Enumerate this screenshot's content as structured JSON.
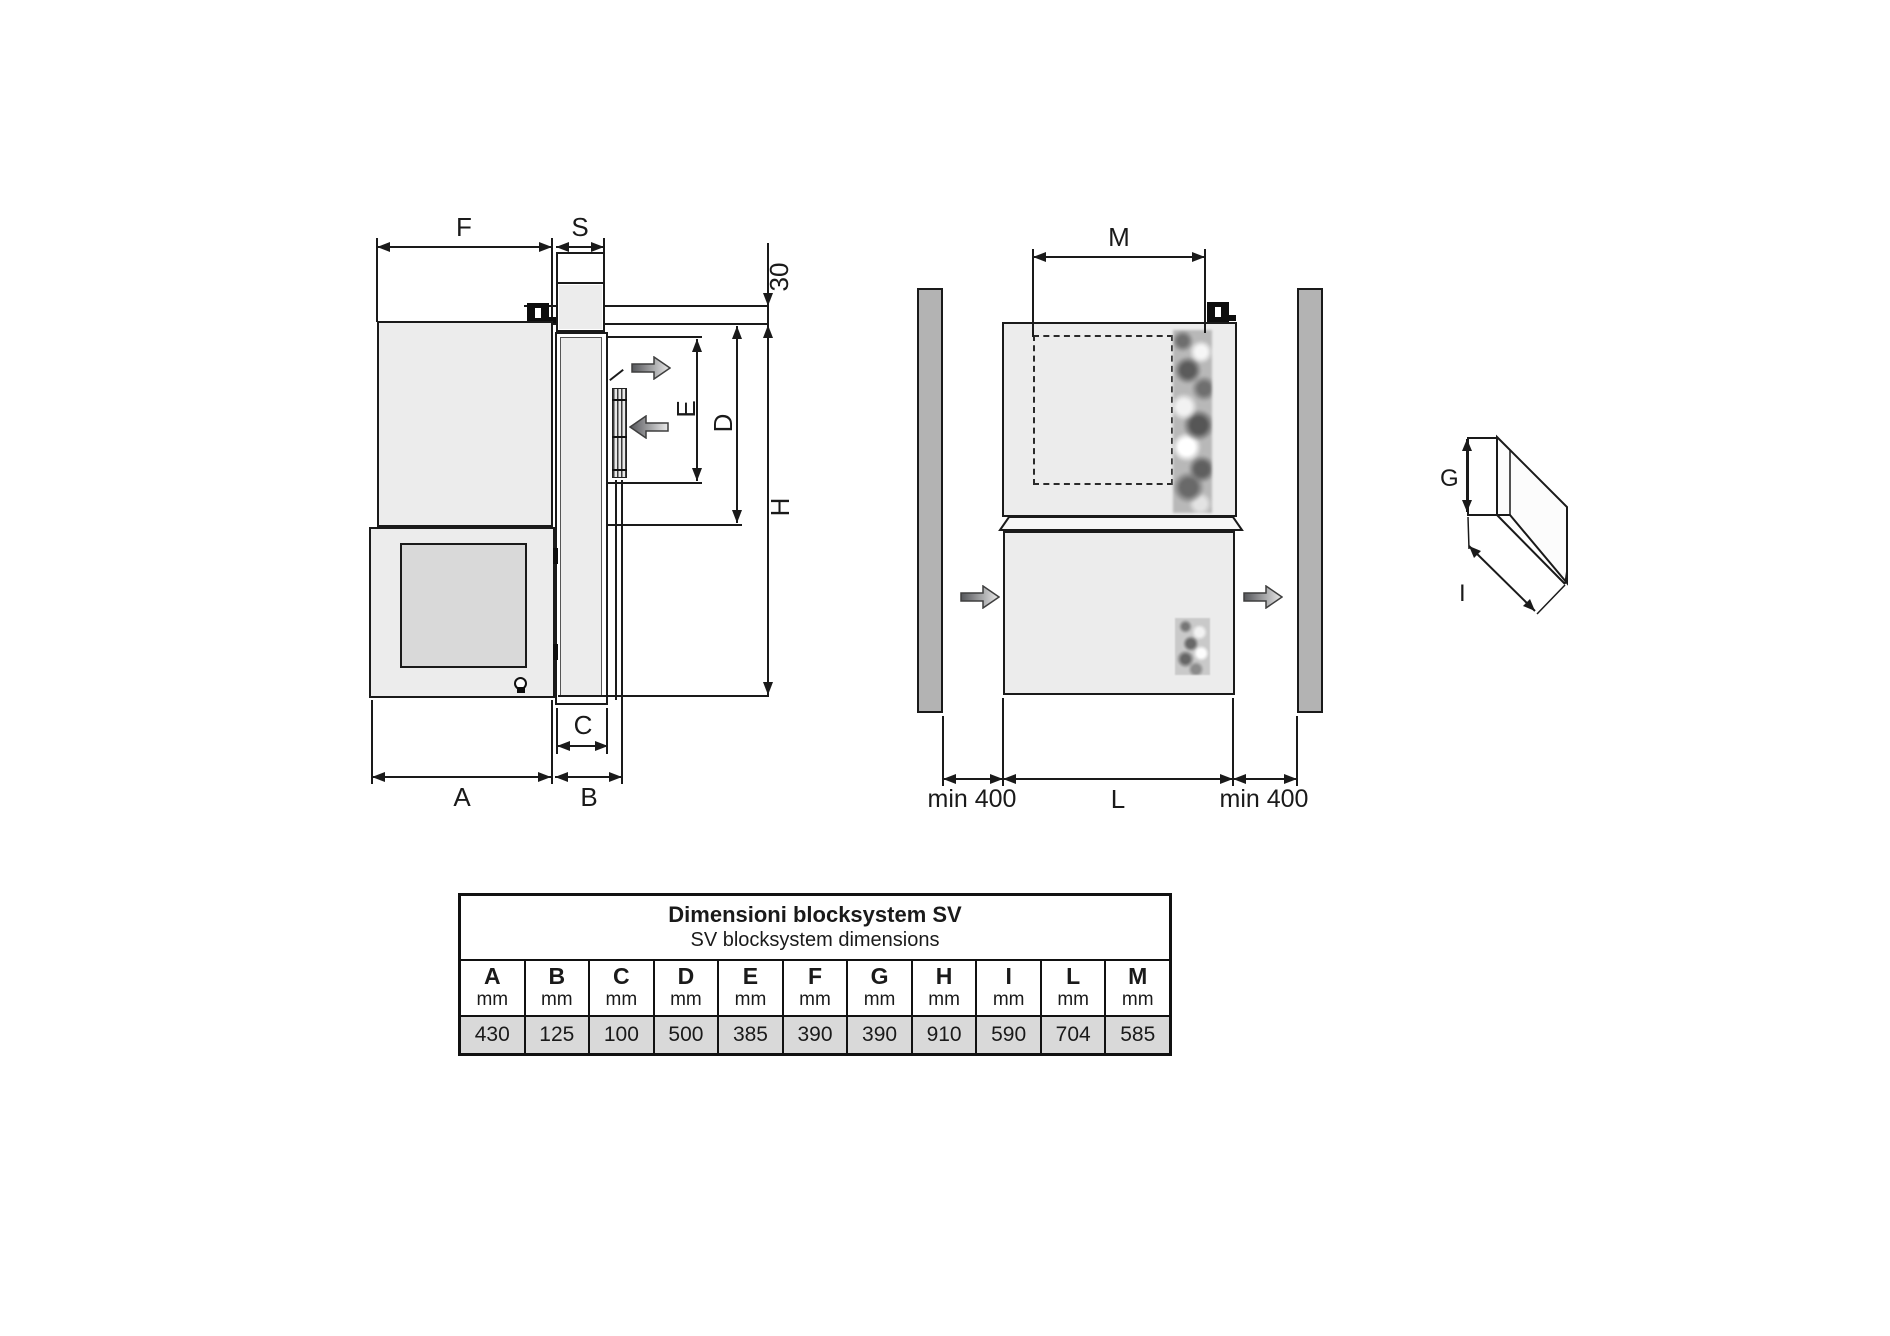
{
  "colors": {
    "line": "#1a1a1a",
    "body_fill": "#ececec",
    "door_fill": "#d9d9d9",
    "wall_fill": "#b3b3b3",
    "table_value_row": "#d9d9d9",
    "canvas": "#ffffff"
  },
  "side_view": {
    "labels": {
      "F": "F",
      "S": "S",
      "ceiling_thickness": "30",
      "E": "E",
      "D": "D",
      "H": "H",
      "C": "C",
      "A": "A",
      "B": "B"
    }
  },
  "front_view": {
    "labels": {
      "M": "M",
      "clearance_left": "min 400",
      "L": "L",
      "clearance_right": "min 400"
    }
  },
  "corner_sketch": {
    "labels": {
      "G": "G",
      "I": "I"
    }
  },
  "table": {
    "title_line1": "Dimensioni blocksystem SV",
    "title_line2": "SV blocksystem dimensions",
    "columns": [
      {
        "letter": "A",
        "unit": "mm",
        "value": "430"
      },
      {
        "letter": "B",
        "unit": "mm",
        "value": "125"
      },
      {
        "letter": "C",
        "unit": "mm",
        "value": "100"
      },
      {
        "letter": "D",
        "unit": "mm",
        "value": "500"
      },
      {
        "letter": "E",
        "unit": "mm",
        "value": "385"
      },
      {
        "letter": "F",
        "unit": "mm",
        "value": "390"
      },
      {
        "letter": "G",
        "unit": "mm",
        "value": "390"
      },
      {
        "letter": "H",
        "unit": "mm",
        "value": "910"
      },
      {
        "letter": "I",
        "unit": "mm",
        "value": "590"
      },
      {
        "letter": "L",
        "unit": "mm",
        "value": "704"
      },
      {
        "letter": "M",
        "unit": "mm",
        "value": "585"
      }
    ]
  }
}
